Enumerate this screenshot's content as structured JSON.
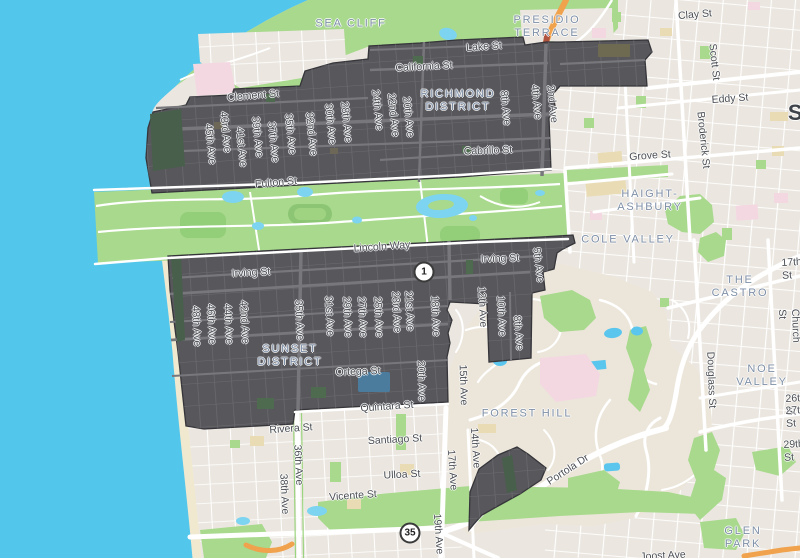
{
  "map": {
    "colors": {
      "ocean": "#53c6eb",
      "land": "#ebe7e0",
      "park_green": "#a8d98d",
      "coverage_dark": "#57575c",
      "beach_sand": "#f0e9d0",
      "district_label": "#7e8fa7",
      "street_label": "#4a4e54",
      "highway_orange": "#f0a24c"
    },
    "city_partial": {
      "text": "S",
      "x": 796,
      "y": 113
    },
    "districts": [
      {
        "text": "SEA CLIFF",
        "x": 351,
        "y": 24
      },
      {
        "text": "PRESIDIO\nTERRACE",
        "x": 547,
        "y": 27
      },
      {
        "text": "RICHMOND\nDISTRICT",
        "x": 458,
        "y": 101
      },
      {
        "text": "HAIGHT-\nASHBURY",
        "x": 650,
        "y": 201
      },
      {
        "text": "COLE VALLEY",
        "x": 628,
        "y": 240
      },
      {
        "text": "THE CASTRO",
        "x": 740,
        "y": 287
      },
      {
        "text": "NOE VALLEY",
        "x": 762,
        "y": 376
      },
      {
        "text": "SUNSET\nDISTRICT",
        "x": 290,
        "y": 356
      },
      {
        "text": "FOREST HILL",
        "x": 527,
        "y": 414
      },
      {
        "text": "GLEN PARK",
        "x": 743,
        "y": 538
      }
    ],
    "streets": [
      {
        "text": "Lake St",
        "x": 484,
        "y": 47,
        "rot": -4
      },
      {
        "text": "California St",
        "x": 424,
        "y": 67,
        "rot": -3
      },
      {
        "text": "Clement St",
        "x": 253,
        "y": 96,
        "rot": -5
      },
      {
        "text": "Cabrillo St",
        "x": 488,
        "y": 151,
        "rot": -2
      },
      {
        "text": "Fulton St",
        "x": 276,
        "y": 183,
        "rot": -5
      },
      {
        "text": "Lincoln Way",
        "x": 382,
        "y": 247,
        "rot": -4
      },
      {
        "text": "Irving St",
        "x": 251,
        "y": 273,
        "rot": -3
      },
      {
        "text": "Irving St",
        "x": 500,
        "y": 259,
        "rot": -2
      },
      {
        "text": "Ortega St",
        "x": 358,
        "y": 372,
        "rot": -2
      },
      {
        "text": "Quintara St",
        "x": 387,
        "y": 407,
        "rot": -4
      },
      {
        "text": "Rivera St",
        "x": 291,
        "y": 429,
        "rot": -4
      },
      {
        "text": "Santiago St",
        "x": 395,
        "y": 440,
        "rot": -3
      },
      {
        "text": "Ulloa St",
        "x": 402,
        "y": 475,
        "rot": -3
      },
      {
        "text": "Vicente St",
        "x": 353,
        "y": 496,
        "rot": -4
      },
      {
        "text": "Clay St",
        "x": 695,
        "y": 15,
        "rot": -5
      },
      {
        "text": "Eddy St",
        "x": 730,
        "y": 99,
        "rot": -4
      },
      {
        "text": "Grove St",
        "x": 650,
        "y": 156,
        "rot": -4
      },
      {
        "text": "Portola Dr",
        "x": 568,
        "y": 470,
        "rot": -33
      },
      {
        "text": "Joost Ave",
        "x": 663,
        "y": 556,
        "rot": -3
      },
      {
        "text": "29th St",
        "x": 794,
        "y": 451,
        "rot": -3
      },
      {
        "text": "17th St",
        "x": 792,
        "y": 269,
        "rot": -3
      },
      {
        "text": "26th St",
        "x": 796,
        "y": 405,
        "rot": -3
      },
      {
        "text": "27th St",
        "x": 796,
        "y": 417,
        "rot": -3
      },
      {
        "text": "Scott St",
        "x": 714,
        "y": 62,
        "rot": 84
      },
      {
        "text": "Broderick St",
        "x": 703,
        "y": 140,
        "rot": 84
      },
      {
        "text": "Church St",
        "x": 789,
        "y": 326,
        "rot": 88
      },
      {
        "text": "Douglass St",
        "x": 711,
        "y": 380,
        "rot": 88
      },
      {
        "text": "45th Ave",
        "x": 210,
        "y": 144,
        "rot": 84
      },
      {
        "text": "43rd Ave",
        "x": 225,
        "y": 132,
        "rot": 84
      },
      {
        "text": "41st Ave",
        "x": 241,
        "y": 147,
        "rot": 84
      },
      {
        "text": "39th Ave",
        "x": 257,
        "y": 137,
        "rot": 84
      },
      {
        "text": "37th Ave",
        "x": 273,
        "y": 142,
        "rot": 84
      },
      {
        "text": "35th Ave",
        "x": 290,
        "y": 134,
        "rot": 84
      },
      {
        "text": "32nd Ave",
        "x": 311,
        "y": 134,
        "rot": 84
      },
      {
        "text": "30th Ave",
        "x": 330,
        "y": 124,
        "rot": 84
      },
      {
        "text": "28th Ave",
        "x": 346,
        "y": 122,
        "rot": 84
      },
      {
        "text": "24th Ave",
        "x": 377,
        "y": 110,
        "rot": 84
      },
      {
        "text": "22nd Ave",
        "x": 393,
        "y": 115,
        "rot": 84
      },
      {
        "text": "20th Ave",
        "x": 408,
        "y": 117,
        "rot": 84
      },
      {
        "text": "8th Ave",
        "x": 505,
        "y": 108,
        "rot": 84
      },
      {
        "text": "4th Ave",
        "x": 536,
        "y": 102,
        "rot": 84
      },
      {
        "text": "2nd Ave",
        "x": 552,
        "y": 104,
        "rot": 84
      },
      {
        "text": "48th Ave",
        "x": 196,
        "y": 326,
        "rot": 87
      },
      {
        "text": "46th Ave",
        "x": 211,
        "y": 324,
        "rot": 87
      },
      {
        "text": "44th Ave",
        "x": 228,
        "y": 324,
        "rot": 87
      },
      {
        "text": "42nd Ave",
        "x": 244,
        "y": 322,
        "rot": 87
      },
      {
        "text": "35th Ave",
        "x": 299,
        "y": 320,
        "rot": 87
      },
      {
        "text": "31st Ave",
        "x": 329,
        "y": 316,
        "rot": 87
      },
      {
        "text": "29th Ave",
        "x": 347,
        "y": 317,
        "rot": 87
      },
      {
        "text": "27th Ave",
        "x": 362,
        "y": 317,
        "rot": 87
      },
      {
        "text": "25th Ave",
        "x": 378,
        "y": 317,
        "rot": 87
      },
      {
        "text": "23rd Ave",
        "x": 396,
        "y": 312,
        "rot": 87
      },
      {
        "text": "21st Ave",
        "x": 409,
        "y": 311,
        "rot": 87
      },
      {
        "text": "18th Ave",
        "x": 435,
        "y": 316,
        "rot": 87
      },
      {
        "text": "12th Ave",
        "x": 482,
        "y": 307,
        "rot": 87
      },
      {
        "text": "10th Ave",
        "x": 501,
        "y": 316,
        "rot": 87
      },
      {
        "text": "8th Ave",
        "x": 518,
        "y": 333,
        "rot": 85
      },
      {
        "text": "5th Ave",
        "x": 538,
        "y": 265,
        "rot": 83
      },
      {
        "text": "20th Ave",
        "x": 421,
        "y": 381,
        "rot": 88
      },
      {
        "text": "15th Ave",
        "x": 463,
        "y": 385,
        "rot": 88
      },
      {
        "text": "14th Ave",
        "x": 475,
        "y": 448,
        "rot": 86
      },
      {
        "text": "17th Ave",
        "x": 452,
        "y": 470,
        "rot": 86
      },
      {
        "text": "19th Ave",
        "x": 438,
        "y": 534,
        "rot": 86
      },
      {
        "text": "36th Ave",
        "x": 298,
        "y": 465,
        "rot": 87
      },
      {
        "text": "38th Ave",
        "x": 284,
        "y": 494,
        "rot": 87
      }
    ],
    "shields": [
      {
        "label": "1",
        "x": 424,
        "y": 272
      },
      {
        "label": "35",
        "x": 410,
        "y": 533
      }
    ]
  }
}
